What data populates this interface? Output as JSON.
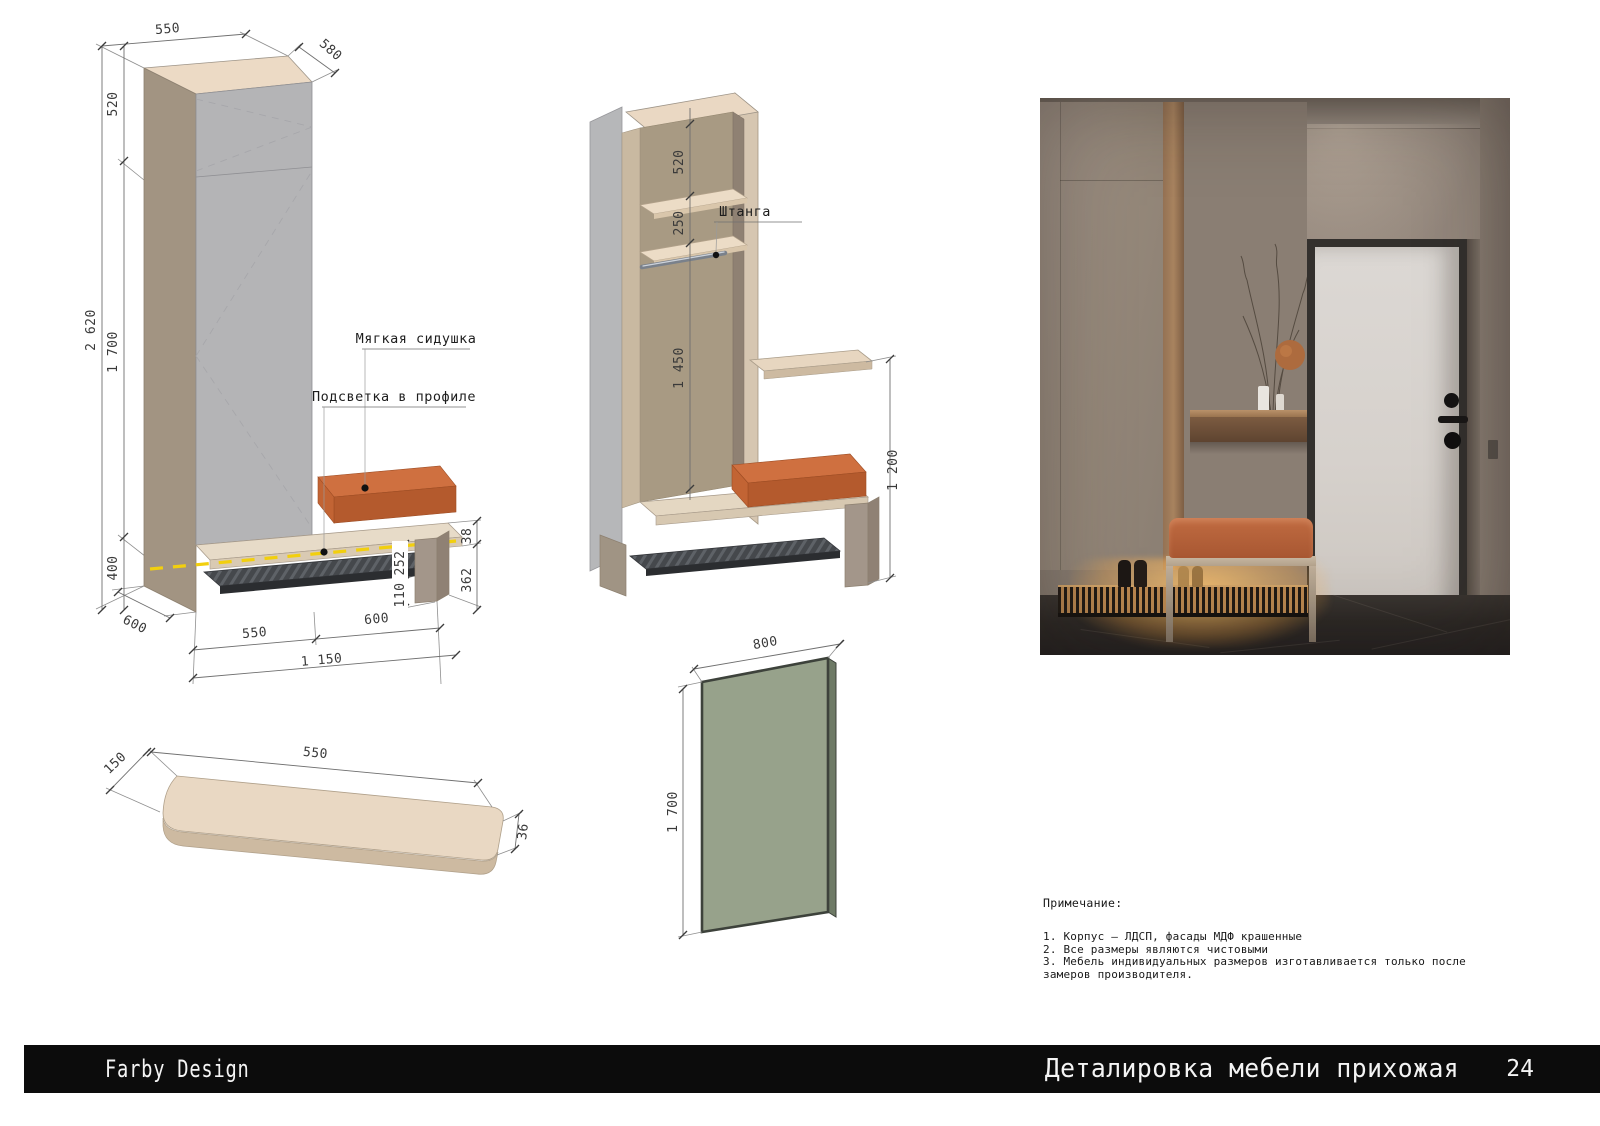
{
  "footer": {
    "brand": "Farby Design",
    "title": "Деталировка мебели прихожая",
    "page_number": "24"
  },
  "drawing_wardrobe_front": {
    "labels": {
      "soft_seat": "Мягкая сидушка",
      "profile_light": "Подсветка в профиле"
    },
    "dims": {
      "top_width": "550",
      "top_depth": "580",
      "upper_section_height": "520",
      "total_height": "2 620",
      "door_section_height": "1 700",
      "base_height": "400",
      "base_depth": "600",
      "left_width": "550",
      "right_width": "600",
      "total_width": "1 150",
      "seat_thickness": "38",
      "bench_height": "362",
      "bench_opening": "252",
      "shoe_shelf_offset": "110"
    }
  },
  "drawing_wardrobe_section": {
    "labels": {
      "rod": "Штанга"
    },
    "dims": {
      "upper_shelf": "520",
      "second_shelf": "250",
      "hanging_height": "1 450",
      "shelf_to_floor": "1 200"
    }
  },
  "drawing_mirror": {
    "dims": {
      "width": "800",
      "height": "1 700"
    }
  },
  "drawing_shelf": {
    "dims": {
      "depth": "150",
      "length": "550",
      "thickness": "36"
    }
  },
  "notes": {
    "title": "Примечание:",
    "lines": [
      "1. Корпус – ЛДСП, фасады МДФ крашенные",
      "2. Все размеры являются чистовыми",
      "3. Мебель индивидуальных размеров изготавливается только после",
      "замеров производителя."
    ]
  },
  "colors": {
    "cushion_orange": "#cf7040",
    "mirror_green": "#97a28b",
    "led_yellow": "#f2cf0e",
    "wood_cream": "#ead8c3",
    "carcass_gray": "#b4b4b6",
    "taupe": "#a29482",
    "footer_black": "#0c0c0c"
  }
}
